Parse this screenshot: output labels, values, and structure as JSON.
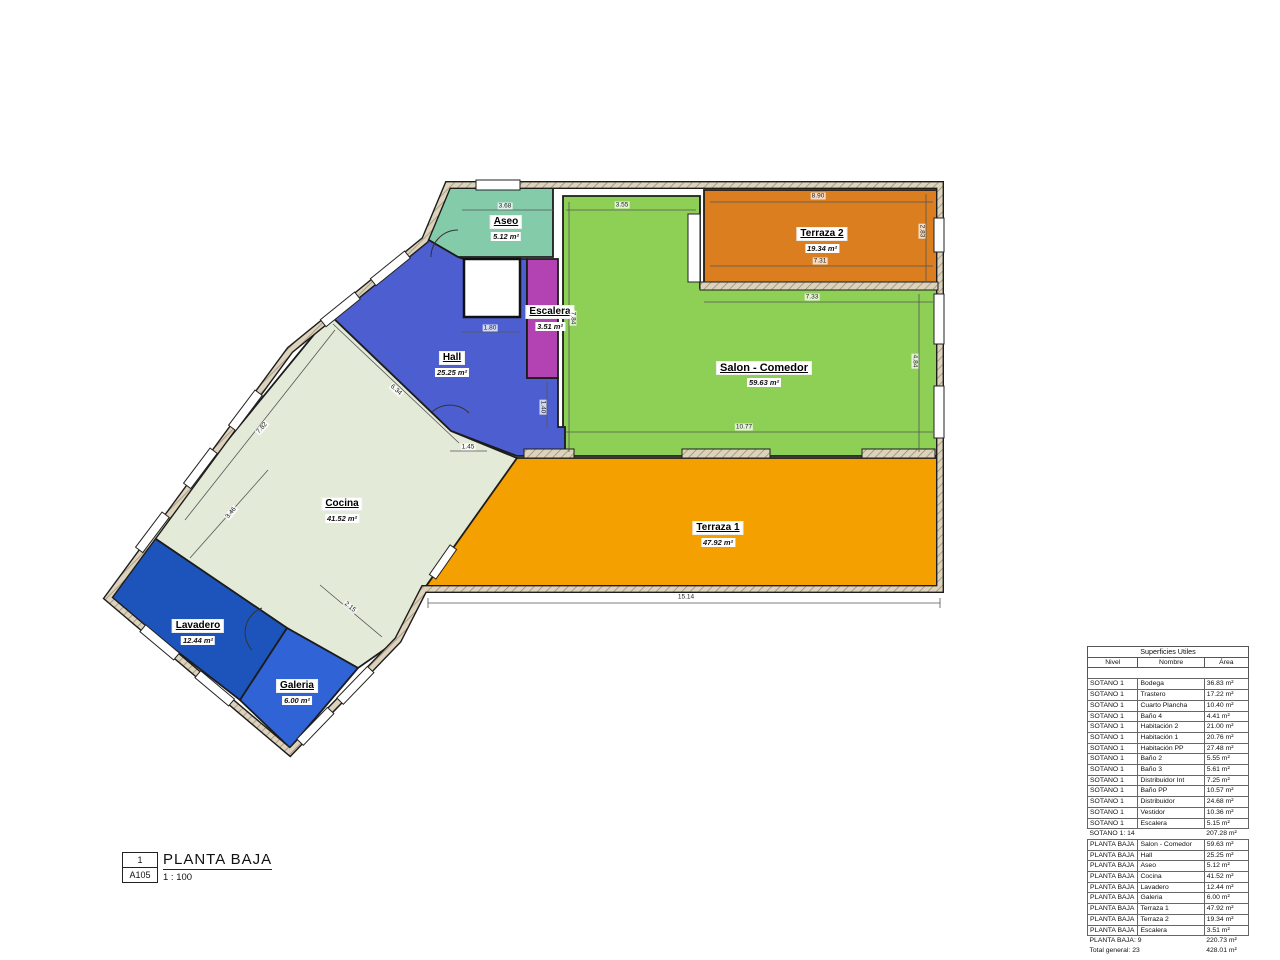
{
  "sheet": {
    "number": "1",
    "code": "A105",
    "title": "PLANTA BAJA",
    "scale": "1 : 100"
  },
  "rooms": [
    {
      "name": "Aseo",
      "area": "5.12 m²"
    },
    {
      "name": "Escalera",
      "area": "3.51 m²"
    },
    {
      "name": "Hall",
      "area": "25.25 m²"
    },
    {
      "name": "Terraza 2",
      "area": "19.34 m²"
    },
    {
      "name": "Salon - Comedor",
      "area": "59.63 m²"
    },
    {
      "name": "Cocina",
      "area": "41.52 m²"
    },
    {
      "name": "Terraza 1",
      "area": "47.92 m²"
    },
    {
      "name": "Lavadero",
      "area": "12.44 m²"
    },
    {
      "name": "Galeria",
      "area": "6.00 m²"
    }
  ],
  "dims": [
    "3.68",
    "3.55",
    "8.90",
    "7.31",
    "7.33",
    "2.83",
    "4.84",
    "7.84",
    "10.77",
    "15.14",
    "1.80",
    "1.40",
    "1.45",
    "7.82",
    "6.34",
    "3.46",
    "2.15"
  ],
  "table": {
    "title": "Superficies Utiles",
    "columns": [
      "Nivel",
      "Nombre",
      "Área"
    ],
    "rows": [
      {
        "type": "data",
        "nivel": "SOTANO 1",
        "nombre": "Bodega",
        "area": "36.83 m²"
      },
      {
        "type": "data",
        "nivel": "SOTANO 1",
        "nombre": "Trastero",
        "area": "17.22 m²"
      },
      {
        "type": "data",
        "nivel": "SOTANO 1",
        "nombre": "Cuarto Plancha",
        "area": "10.40 m²"
      },
      {
        "type": "data",
        "nivel": "SOTANO 1",
        "nombre": "Baño 4",
        "area": "4.41 m²"
      },
      {
        "type": "data",
        "nivel": "SOTANO 1",
        "nombre": "Habitación 2",
        "area": "21.00 m²"
      },
      {
        "type": "data",
        "nivel": "SOTANO 1",
        "nombre": "Habitación 1",
        "area": "20.76 m²"
      },
      {
        "type": "data",
        "nivel": "SOTANO 1",
        "nombre": "Habitación PP",
        "area": "27.48 m²"
      },
      {
        "type": "data",
        "nivel": "SOTANO 1",
        "nombre": "Baño 2",
        "area": "5.55 m²"
      },
      {
        "type": "data",
        "nivel": "SOTANO 1",
        "nombre": "Baño 3",
        "area": "5.61 m²"
      },
      {
        "type": "data",
        "nivel": "SOTANO 1",
        "nombre": "Distribuidor Int",
        "area": "7.25 m²"
      },
      {
        "type": "data",
        "nivel": "SOTANO 1",
        "nombre": "Baño PP",
        "area": "10.57 m²"
      },
      {
        "type": "data",
        "nivel": "SOTANO 1",
        "nombre": "Distribuidor",
        "area": "24.68 m²"
      },
      {
        "type": "data",
        "nivel": "SOTANO 1",
        "nombre": "Vestidor",
        "area": "10.36 m²"
      },
      {
        "type": "data",
        "nivel": "SOTANO 1",
        "nombre": "Escalera",
        "area": "5.15 m²"
      },
      {
        "type": "subtotal",
        "label": "SOTANO 1: 14",
        "area": "207.28 m²"
      },
      {
        "type": "data",
        "nivel": "PLANTA BAJA",
        "nombre": "Salon - Comedor",
        "area": "59.63 m²"
      },
      {
        "type": "data",
        "nivel": "PLANTA BAJA",
        "nombre": "Hall",
        "area": "25.25 m²"
      },
      {
        "type": "data",
        "nivel": "PLANTA BAJA",
        "nombre": "Aseo",
        "area": "5.12 m²"
      },
      {
        "type": "data",
        "nivel": "PLANTA BAJA",
        "nombre": "Cocina",
        "area": "41.52 m²"
      },
      {
        "type": "data",
        "nivel": "PLANTA BAJA",
        "nombre": "Lavadero",
        "area": "12.44 m²"
      },
      {
        "type": "data",
        "nivel": "PLANTA BAJA",
        "nombre": "Galeria",
        "area": "6.00 m²"
      },
      {
        "type": "data",
        "nivel": "PLANTA BAJA",
        "nombre": "Terraza 1",
        "area": "47.92 m²"
      },
      {
        "type": "data",
        "nivel": "PLANTA BAJA",
        "nombre": "Terraza 2",
        "area": "19.34 m²"
      },
      {
        "type": "data",
        "nivel": "PLANTA BAJA",
        "nombre": "Escalera",
        "area": "3.51 m²"
      },
      {
        "type": "subtotal",
        "label": "PLANTA BAJA: 9",
        "area": "220.73 m²"
      },
      {
        "type": "total",
        "label": "Total general: 23",
        "area": "428.01 m²"
      }
    ]
  },
  "colors": {
    "aseo": "#84cbaa",
    "escalera": "#b342b3",
    "hall": "#4d5fd0",
    "salon": "#8ed055",
    "terraza2": "#da7e1f",
    "terraza1": "#f4a000",
    "cocina": "#e3ead8",
    "lavadero": "#1d54bc",
    "galeria": "#2f63d6"
  }
}
